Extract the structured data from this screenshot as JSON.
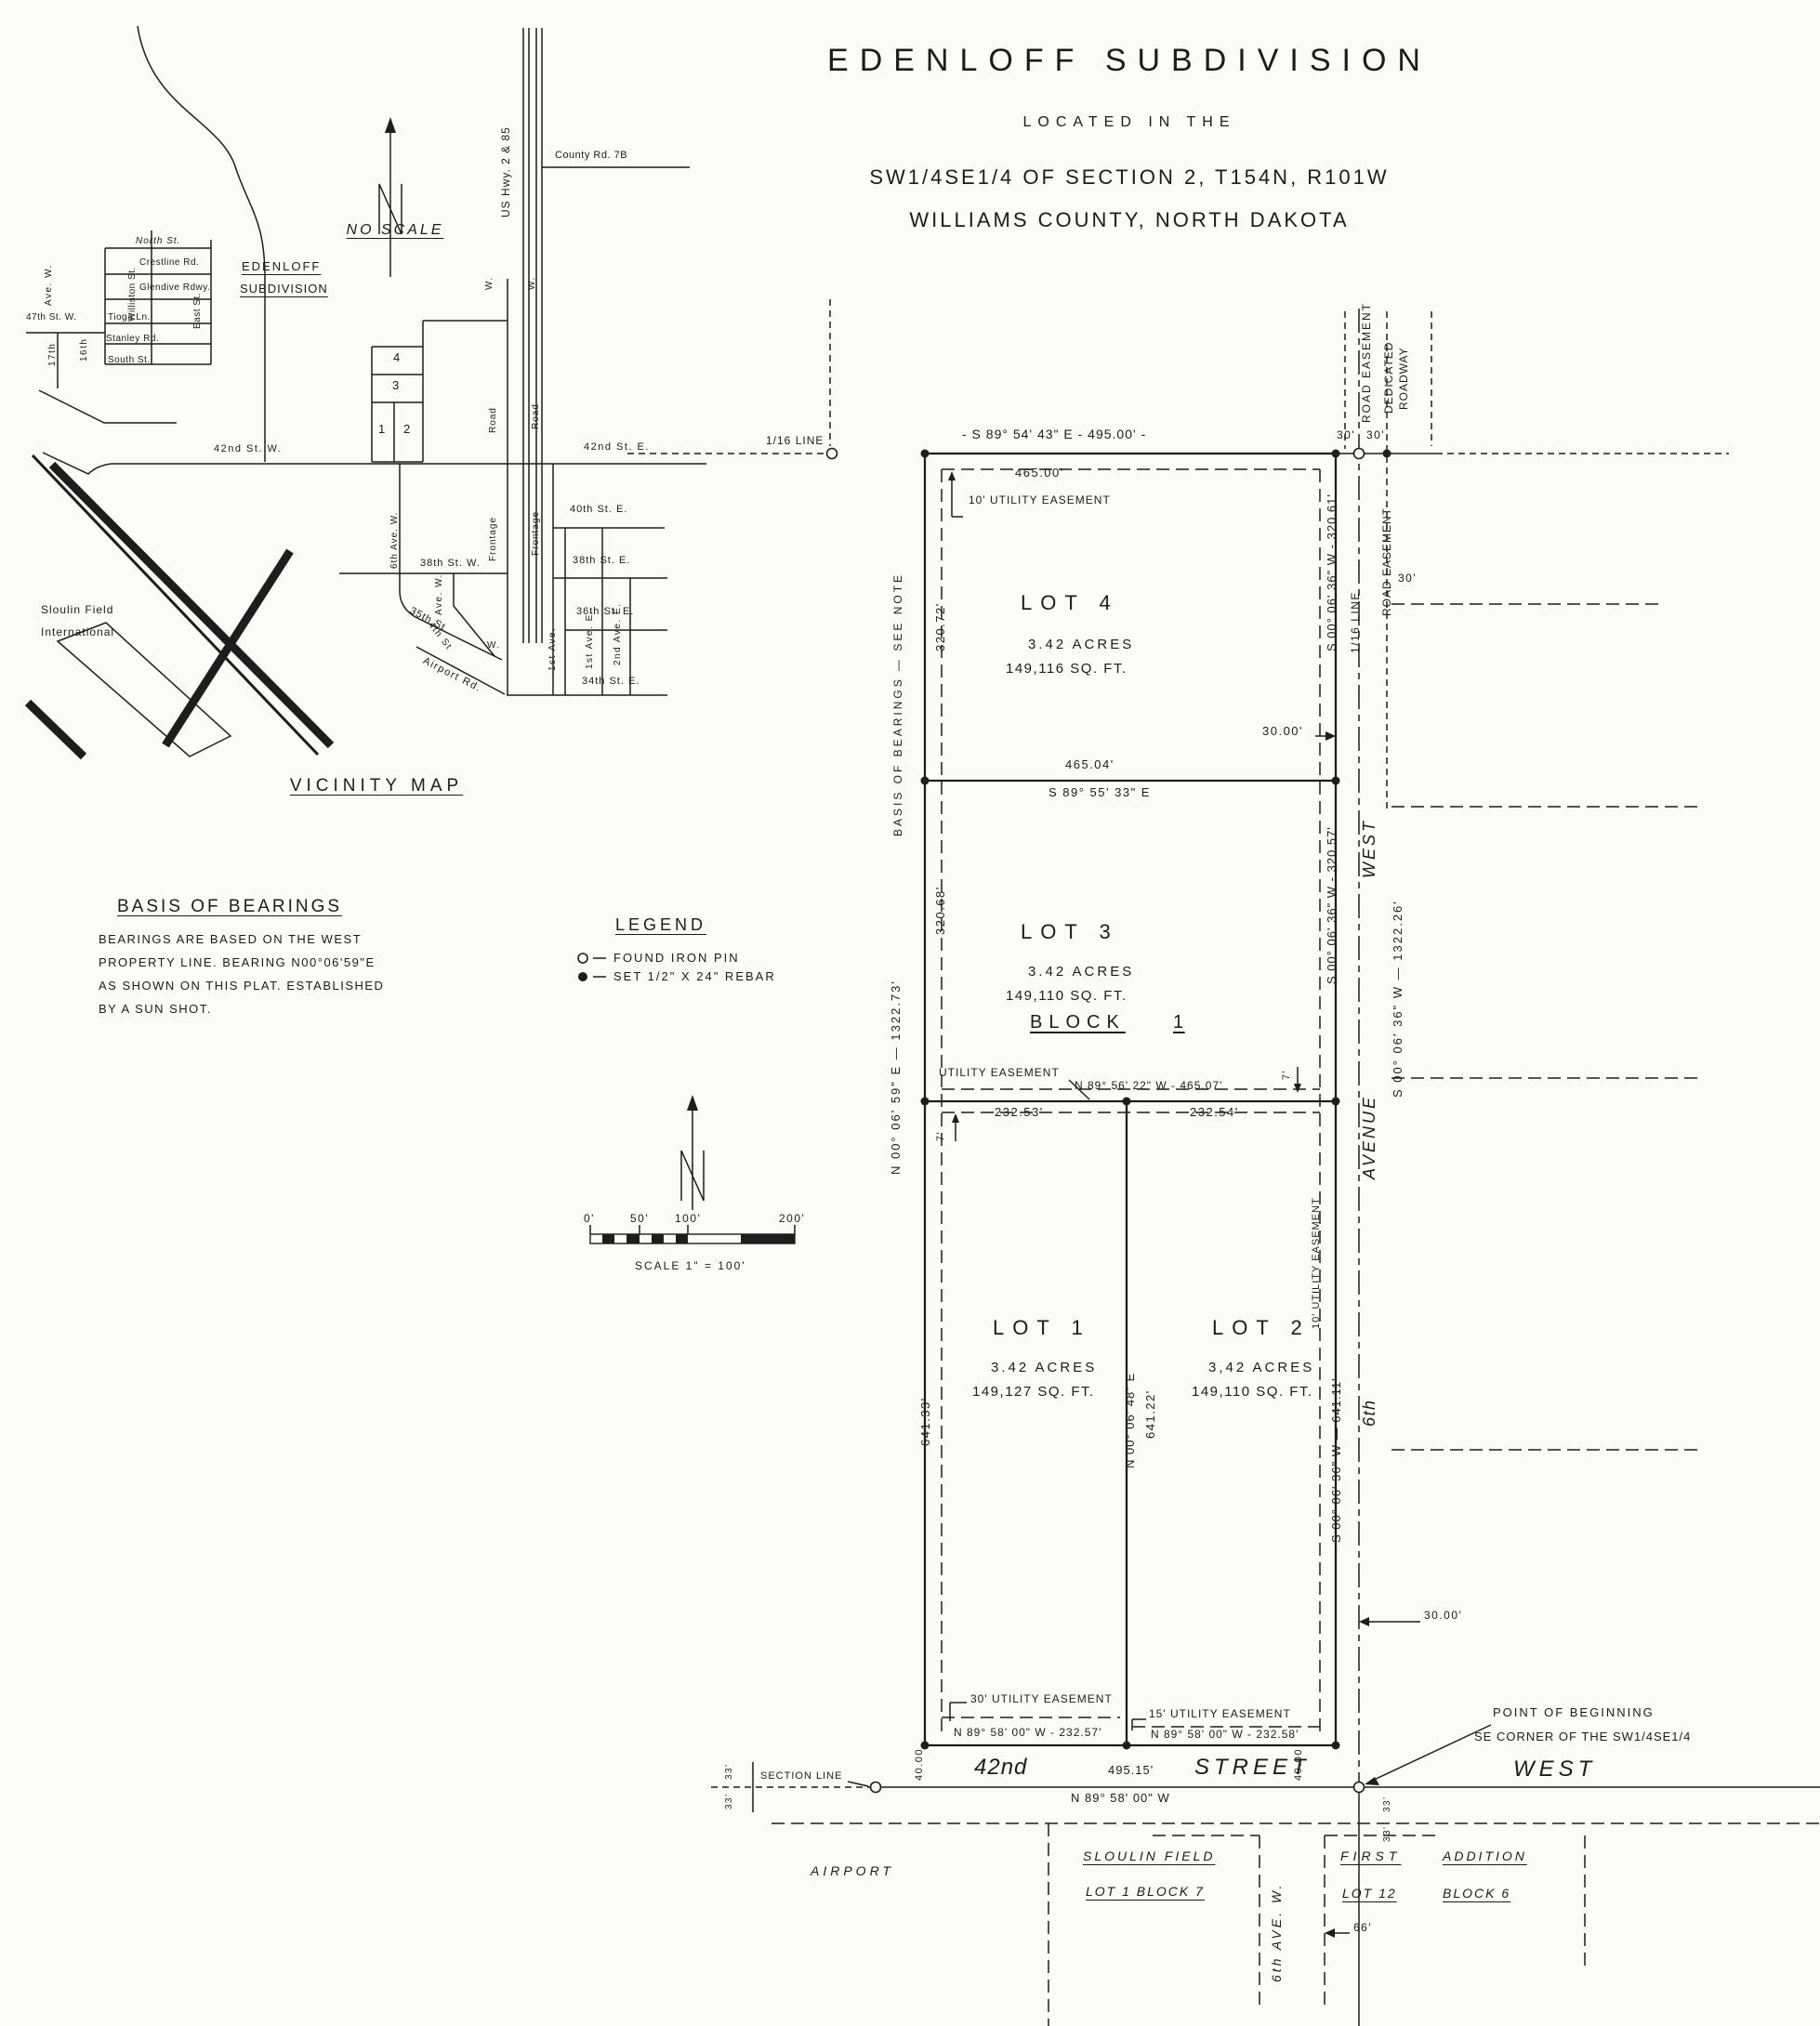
{
  "title": {
    "name": "EDENLOFF  SUBDIVISION",
    "located": "LOCATED IN THE",
    "section": "SW1/4SE1/4 OF SECTION 2, T154N, R101W",
    "county": "WILLIAMS COUNTY, NORTH DAKOTA"
  },
  "vicinity": {
    "heading": "VICINITY MAP",
    "no_scale": "NO SCALE",
    "north": "N",
    "county_rd": "County Rd. 7B",
    "us_hwy": "US Hwy. 2 & 85",
    "north_st": "North St.",
    "crestline": "Crestline Rd.",
    "glendive": "Glendive Rdwy.",
    "tioga": "Tioga Ln.",
    "stanley": "Stanley Rd.",
    "south_st": "South St.",
    "williston": "Williston St.",
    "east_st": "East St.",
    "ave_w_17": "Ave. W.",
    "st_47": "47th St. W.",
    "n17": "17th",
    "n16": "16th",
    "edenloff1": "EDENLOFF",
    "edenloff2": "SUBDIVISION",
    "n1": "1",
    "n2": "2",
    "n3": "3",
    "n4": "4",
    "st42w": "42nd St. W.",
    "st42e": "42nd St. E.",
    "ave6w": "6th Ave. W.",
    "st38w": "38th St. W.",
    "st35": "35th St",
    "ave4w": "Ave. W.",
    "st4": "4th St",
    "w1": "W.",
    "w2": "W.",
    "w3": "W.",
    "airport_rd": "Airport Rd.",
    "st40e": "40th St. E.",
    "st38e": "38th St. E.",
    "st36e": "36th St. E.",
    "st34e": "34th St. E.",
    "frontage_w": "Frontage",
    "road_w": "Road",
    "frontage_e": "Frontage",
    "road_e": "Road",
    "ave1st_a": "1st Ave.",
    "ave1st_b": "1st Ave. E.",
    "ave2nd": "2nd Ave. E.",
    "sloulin1": "Sloulin Field",
    "sloulin2": "International"
  },
  "notes": {
    "basis_heading": "BASIS OF BEARINGS",
    "basis1": "BEARINGS ARE BASED ON THE WEST",
    "basis2": "PROPERTY LINE.  BEARING N00°06'59\"E",
    "basis3": "AS SHOWN ON THIS PLAT.  ESTABLISHED",
    "basis4": "BY A SUN SHOT."
  },
  "legend": {
    "heading": "LEGEND",
    "found": "FOUND IRON PIN",
    "set": "SET 1/2\" X 24\" REBAR"
  },
  "scalebar": {
    "t0": "0'",
    "t50": "50'",
    "t100": "100'",
    "t200": "200'",
    "caption": "SCALE 1\" = 100'"
  },
  "plat": {
    "sixteenth_top": "1/16 LINE",
    "north_bearing": "- S 89° 54' 43\" E - 495.00' -",
    "d465_00": "465.00'",
    "util10_top": "10' UTILITY EASEMENT",
    "t30a": "30'",
    "t30b": "30'",
    "t30c": "30'",
    "road_easement_a": "ROAD EASEMENT",
    "dedicated": "DEDICATED",
    "roadway": "ROADWAY",
    "road_easement_b": "ROAD EASEMENT",
    "lot4": "LOT 4",
    "lot4_acres": "3.42 ACRES",
    "lot4_sqft": "149,116 SQ. FT.",
    "w320_72": "320.72'",
    "basis_note": "BASIS OF BEARINGS — SEE NOTE",
    "e320_61": "S 00° 06' 36\" W - 320.61'",
    "sixteenth_right": "1/16 LINE",
    "d30_00a": "30.00'",
    "d465_04": "465.04'",
    "b465_04": "S 89° 55' 33\" E",
    "lot3": "LOT 3",
    "lot3_acres": "3.42 ACRES",
    "lot3_sqft": "149,110 SQ. FT.",
    "w320_68": "320.68'",
    "e320_57": "S 00° 06' 36\" W - 320.57'",
    "block": "BLOCK",
    "block_no": "1",
    "util_label": "UTILITY EASEMENT",
    "b465_07": "N 89° 56' 22\" W - 465.07'",
    "d232_53": "232.53'",
    "d232_54": "232.54'",
    "seven_a": "7'",
    "seven_b": "7'",
    "w_bearing": "N 00° 06' 59\" E — 1322.73'",
    "e_bearing": "S 00° 06' 36\" W — 1322.26'",
    "st_west": "WEST",
    "st_avenue": "AVENUE",
    "st_6th": "6th",
    "lot1": "LOT 1",
    "lot1_acres": "3.42 ACRES",
    "lot1_sqft": "149,127 SQ. FT.",
    "lot2": "LOT 2",
    "lot2_acres": "3,42 ACRES",
    "lot2_sqft": "149,110 SQ. FT.",
    "d641_33": "641.33'",
    "mid_bearing": "N 00° 06' 48\" E",
    "d641_22": "641.22'",
    "util10_right": "10' UTILITY EASEMENT",
    "e641_11": "S 00° 06' 36\" W — 641.11'",
    "d30_00b": "30.00'",
    "util30": "30' UTILITY EASEMENT",
    "b232_57": "N 89° 58' 00\" W - 232.57'",
    "util15": "15' UTILITY EASEMENT",
    "b232_58": "N 89° 58' 00\" W - 232.58'",
    "d40a": "40.00",
    "d40b": "40.00",
    "pob1": "POINT OF BEGINNING",
    "pob2": "SE CORNER OF THE SW1/4SE1/4",
    "section_line": "SECTION LINE",
    "t33a": "33'",
    "t33b": "33'",
    "t33c": "33'",
    "t33d": "33'"
  },
  "street42": {
    "name1": "42nd",
    "len": "495.15'",
    "name2": "STREET",
    "bearing": "N 89° 58' 00\" W",
    "name3": "WEST"
  },
  "south": {
    "airport": "AIRPORT",
    "sloulin": "SLOULIN FIELD",
    "lot1b7": "LOT 1  BLOCK 7",
    "ave6": "6th AVE. W.",
    "first": "FIRST",
    "addition": "ADDITION",
    "lot12": "LOT 12",
    "block6": "BLOCK 6",
    "d66": "66'"
  }
}
